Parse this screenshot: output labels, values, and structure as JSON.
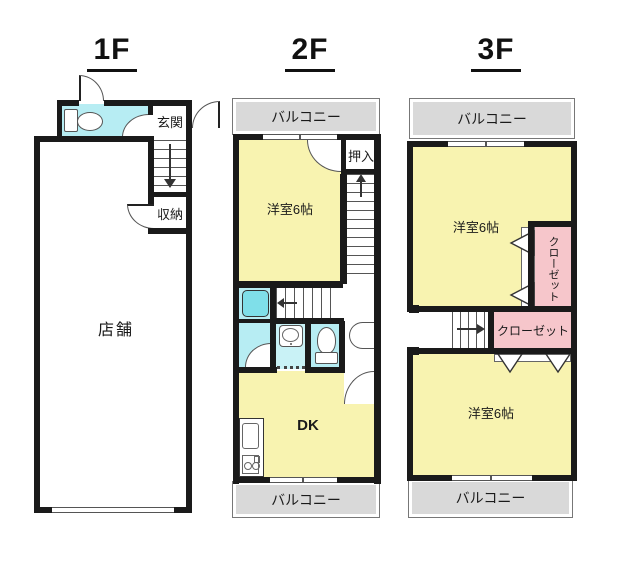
{
  "titles": {
    "f1": "1F",
    "f2": "2F",
    "f3": "3F"
  },
  "floor1": {
    "shop": "店舗",
    "entrance": "玄関",
    "storage": "収納"
  },
  "floor2": {
    "balcony_top": "バルコニー",
    "bedroom": "洋室6帖",
    "oshiire": "押入",
    "dk": "DK",
    "balcony_bottom": "バルコニー"
  },
  "floor3": {
    "balcony_top": "バルコニー",
    "bedroom_upper": "洋室6帖",
    "closet_upper": "クローゼット",
    "closet_lower": "クローゼット",
    "bedroom_lower": "洋室6帖",
    "balcony_bottom": "バルコニー"
  },
  "colors": {
    "wall": "#1a1a1a",
    "room_yellow": "#f8f3b0",
    "water_cyan": "#b7edf3",
    "tub_cyan": "#7fdfe9",
    "balcony_gray": "#d9d9d9",
    "closet_pink": "#f6c6cb"
  }
}
